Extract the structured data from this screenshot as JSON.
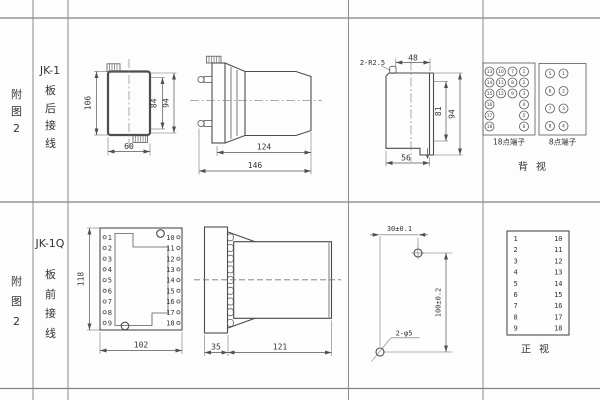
{
  "sheet": {
    "rows": [
      {
        "figure_label": "附图2",
        "model": "JK-1",
        "wiring_type": "板后接线",
        "rear_view": {
          "dim_height": "106",
          "dim_case_height": "84",
          "dim_flange_height": "94",
          "dim_width": "60"
        },
        "side_view": {
          "dim_depth": "124",
          "dim_total_depth": "146"
        },
        "section_view": {
          "corner_note": "2-R2.5",
          "dim_top_width": "48",
          "dim_inner_height": "81",
          "dim_height": "94",
          "dim_bottom_width": "56"
        },
        "terminal_18": {
          "label": "18点端子",
          "numbers": [
            "13",
            "10",
            "7",
            "1",
            "14",
            "11",
            "8",
            "2",
            "15",
            "12",
            "9",
            "3",
            "16",
            "4",
            "17",
            "5",
            "18",
            "6"
          ]
        },
        "terminal_8": {
          "label": "8点端子",
          "numbers": [
            "5",
            "1",
            "6",
            "2",
            "7",
            "3",
            "8",
            "4"
          ]
        },
        "view_label": "背视"
      },
      {
        "figure_label": "附图2",
        "model": "JK-1Q",
        "wiring_type": "板前接线",
        "panel_view": {
          "dim_height": "118",
          "dim_width": "102",
          "left_terminals": [
            "1",
            "2",
            "3",
            "4",
            "5",
            "6",
            "7",
            "8",
            "9"
          ],
          "right_terminals": [
            "10",
            "11",
            "12",
            "13",
            "14",
            "15",
            "16",
            "17",
            "18"
          ]
        },
        "side_view": {
          "dim_panel": "35",
          "dim_body": "121"
        },
        "drill_view": {
          "dim_horizontal": "30±0.1",
          "dim_vertical": "100±0.2",
          "hole_note": "2-φ5"
        },
        "front_view_table": {
          "left": [
            "1",
            "2",
            "3",
            "4",
            "5",
            "6",
            "7",
            "8",
            "9"
          ],
          "right": [
            "10",
            "11",
            "12",
            "13",
            "14",
            "15",
            "16",
            "17",
            "18"
          ],
          "view_label": "正视"
        }
      }
    ]
  }
}
